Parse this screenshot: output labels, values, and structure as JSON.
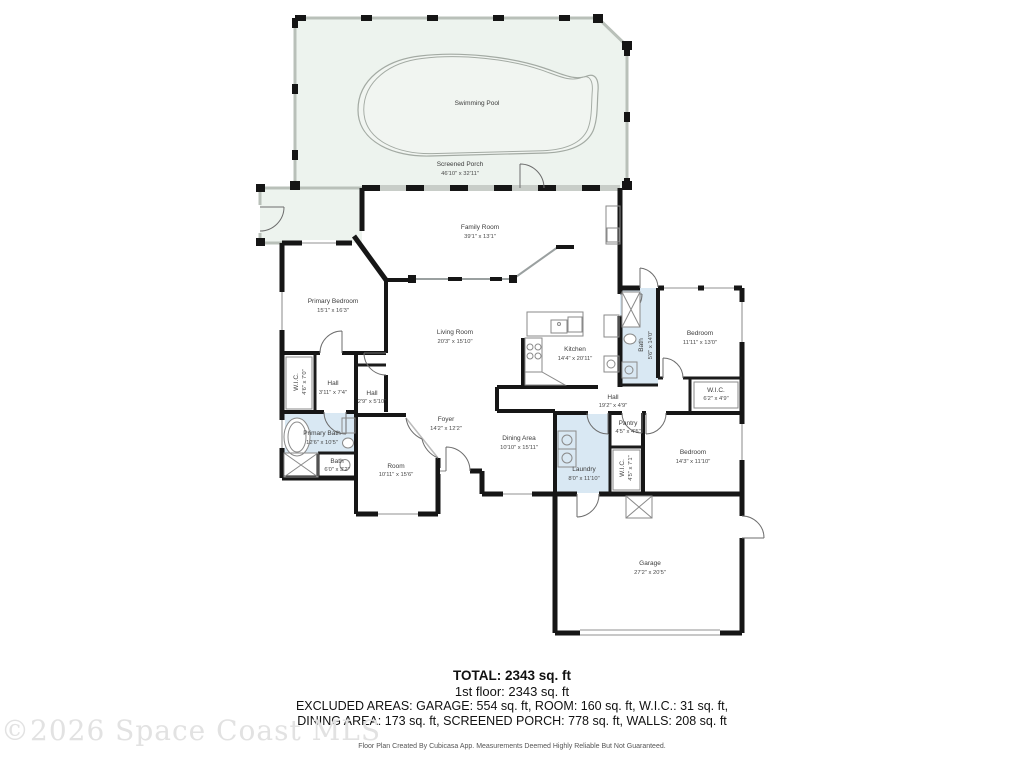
{
  "plan": {
    "rooms": [
      {
        "name": "Swimming Pool",
        "dims": ""
      },
      {
        "name": "Screened Porch",
        "dims": "46'10\" x 32'11\""
      },
      {
        "name": "Family Room",
        "dims": "39'1\" x 13'1\""
      },
      {
        "name": "Primary Bedroom",
        "dims": "15'1\" x 16'3\""
      },
      {
        "name": "Living Room",
        "dims": "20'3\" x 15'10\""
      },
      {
        "name": "Kitchen",
        "dims": "14'4\" x 20'11\""
      },
      {
        "name": "Bath",
        "dims": "5'6\" x 14'0\""
      },
      {
        "name": "Bedroom",
        "dims": "11'11\" x 13'0\""
      },
      {
        "name": "W.I.C.",
        "dims": "6'2\" x 4'9\""
      },
      {
        "name": "Hall",
        "dims": "19'2\" x 4'9\""
      },
      {
        "name": "W.I.C.",
        "dims": "4'6\" x 7'0\""
      },
      {
        "name": "Hall",
        "dims": "3'11\" x 7'4\""
      },
      {
        "name": "Hall",
        "dims": "2'9\" x 5'10\""
      },
      {
        "name": "Primary Bath",
        "dims": "12'6\" x 10'5\""
      },
      {
        "name": "Bath",
        "dims": "6'0\" x 3'2\""
      },
      {
        "name": "Room",
        "dims": "10'11\" x 15'6\""
      },
      {
        "name": "Foyer",
        "dims": "14'2\" x 12'2\""
      },
      {
        "name": "Dining Area",
        "dims": "10'10\" x 15'11\""
      },
      {
        "name": "Laundry",
        "dims": "8'0\" x 11'10\""
      },
      {
        "name": "Pantry",
        "dims": "4'5\" x 4'5\""
      },
      {
        "name": "W.I.C.",
        "dims": "4'5\" x 7'1\""
      },
      {
        "name": "Bedroom",
        "dims": "14'3\" x 11'10\""
      },
      {
        "name": "Garage",
        "dims": "27'2\" x 20'5\""
      }
    ],
    "colors": {
      "wet_room_fill": "#d9e8f3",
      "porch_fill": "#edf3ee",
      "pool_fill": "#f1f5f1",
      "wall": "#161616"
    }
  },
  "summary": {
    "total": "TOTAL: 2343 sq. ft",
    "floor": "1st floor: 2343 sq. ft",
    "excluded_line1": "EXCLUDED AREAS: GARAGE: 554 sq. ft, ROOM: 160 sq. ft, W.I.C.: 31 sq. ft,",
    "excluded_line2": "DINING AREA: 173 sq. ft, SCREENED PORCH: 778 sq. ft, WALLS: 208 sq. ft"
  },
  "footer": {
    "disclaimer": "Floor Plan Created By Cubicasa App. Measurements Deemed Highly Reliable But Not Guaranteed."
  },
  "watermark": {
    "text": "©2026 Space Coast MLS"
  }
}
